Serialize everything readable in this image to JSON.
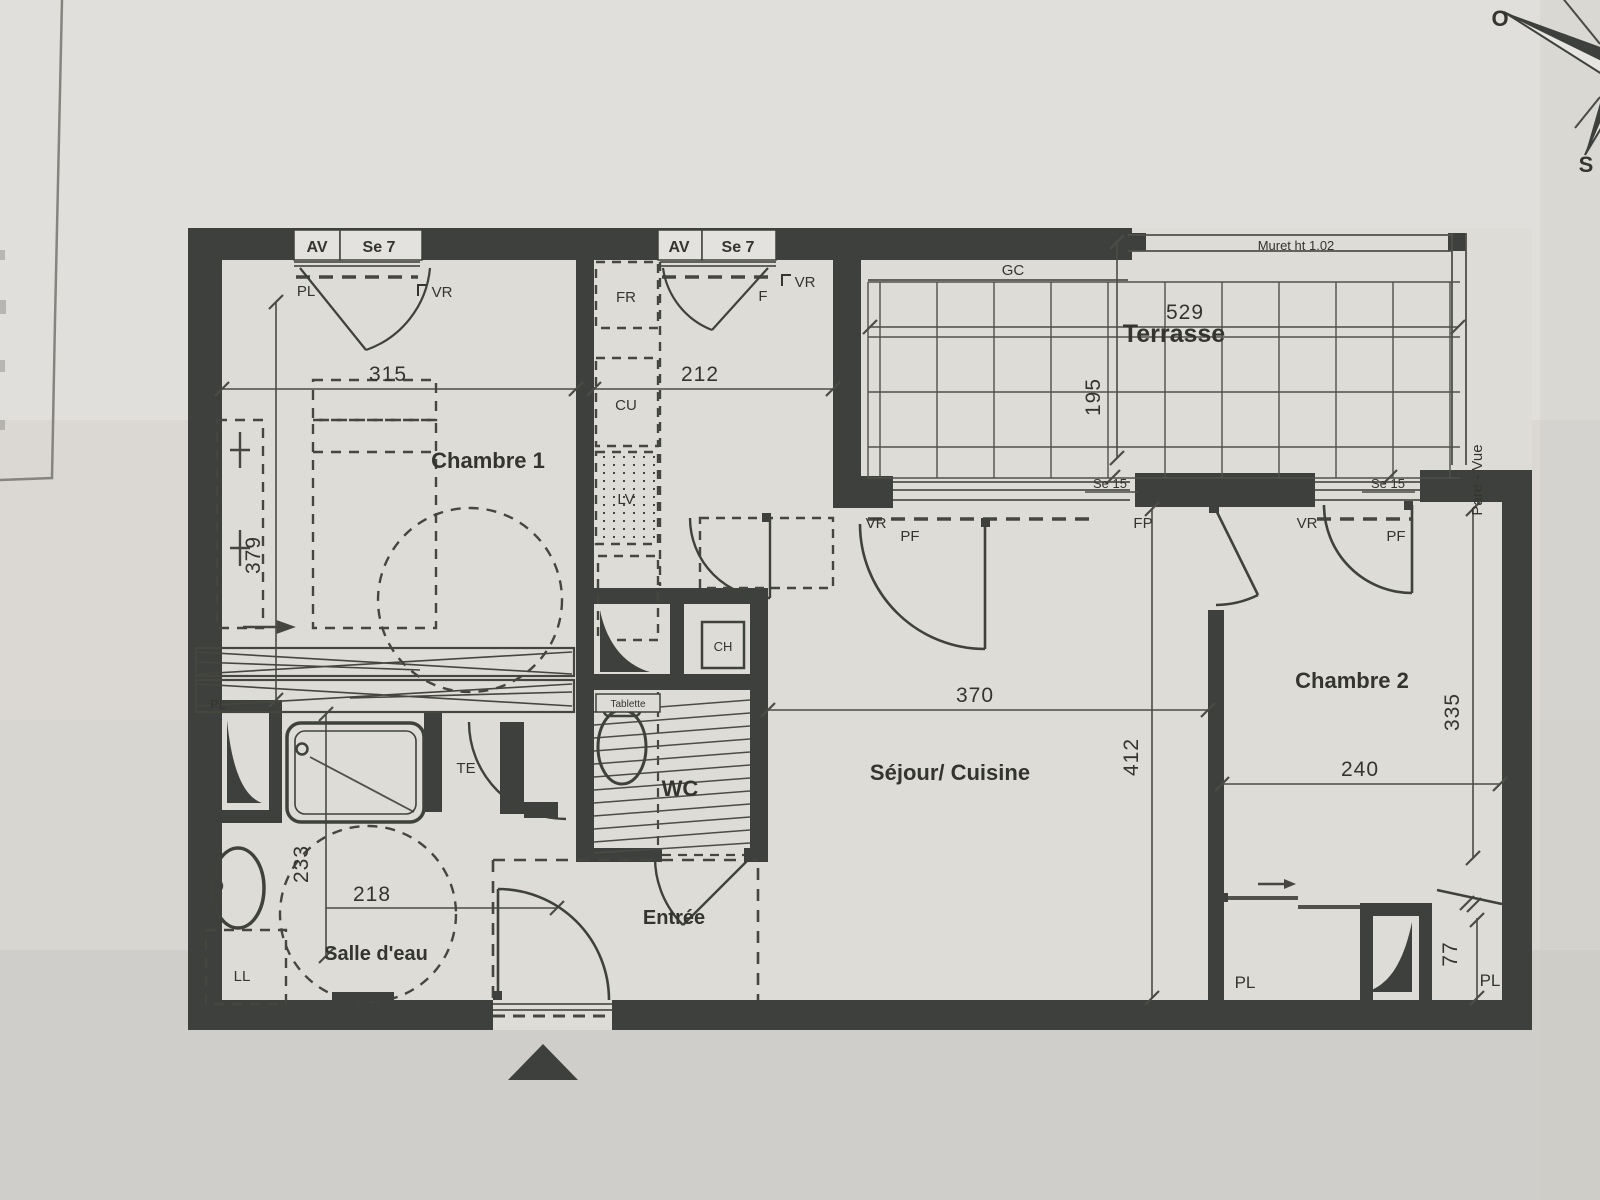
{
  "colors": {
    "paper": "#d8d6d1",
    "paper_light": "#e9e8e4",
    "paper_dark": "#c8c6c1",
    "wall": "#3d403c",
    "line": "#50514b",
    "text": "#34352f"
  },
  "compass": {
    "west": "O",
    "south": "S"
  },
  "rooms": {
    "chambre1": "Chambre 1",
    "chambre2": "Chambre 2",
    "terrasse": "Terrasse",
    "sejour": "Séjour/ Cuisine",
    "salle_eau": "Salle d'eau",
    "wc": "WC",
    "entree": "Entrée"
  },
  "dims": {
    "d315": "315",
    "d212": "212",
    "d529": "529",
    "d195": "195",
    "d379": "379",
    "d370": "370",
    "d412": "412",
    "d335": "335",
    "d240": "240",
    "d218": "218",
    "d233": "233",
    "d77": "77"
  },
  "windows": {
    "av_1": "AV",
    "se7_1": "Se 7",
    "pl_1": "PL",
    "vr_1": "VR",
    "av_2": "AV",
    "se7_2": "Se 7",
    "f_2": "F",
    "vr_2": "VR"
  },
  "terrace": {
    "gc": "GC",
    "muret": "Muret ht 1.02",
    "pare_vue": "Pare - Vue",
    "se15_1": "Se 15",
    "se15_2": "Se 15",
    "vr_pf1": "VR",
    "pf_1": "PF",
    "fp": "FP",
    "vr_pf2": "VR",
    "pf_2": "PF"
  },
  "kitchen": {
    "fr": "FR",
    "cu": "CU",
    "lv": "LV"
  },
  "fixtures": {
    "ch": "CH",
    "te": "TE",
    "tablette": "Tablette",
    "ll": "LL"
  },
  "closets": {
    "pl_hall": "PL",
    "pl_ch2_left": "PL",
    "pl_ch2_right": "PL"
  }
}
